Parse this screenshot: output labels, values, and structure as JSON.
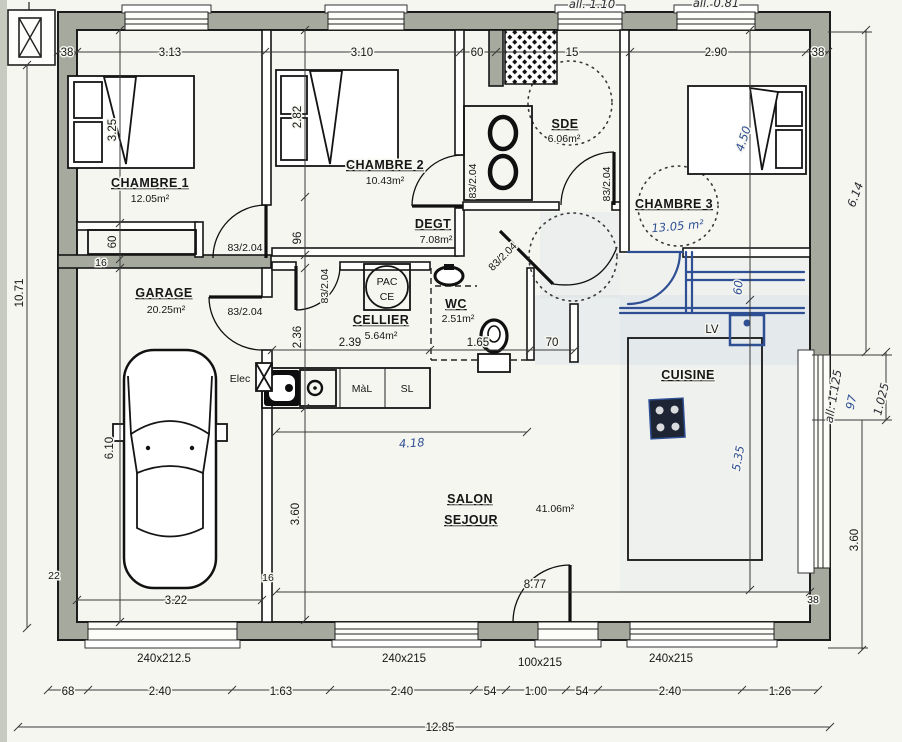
{
  "plan": {
    "rooms": {
      "chambre1": {
        "name": "CHAMBRE 1",
        "area": "12.05m²"
      },
      "chambre2": {
        "name": "CHAMBRE 2",
        "area": "10.43m²"
      },
      "chambre3": {
        "name": "CHAMBRE 3",
        "area": "13.05 m²"
      },
      "sde": {
        "name": "SDE",
        "area": "6.06m²"
      },
      "degt": {
        "name": "DEGT",
        "area": "7.08m²"
      },
      "garage": {
        "name": "GARAGE",
        "area": "20.25m²"
      },
      "cellier": {
        "name": "CELLIER",
        "area": "5.64m²"
      },
      "wc": {
        "name": "WC",
        "area": "2.51m²"
      },
      "cuisine": {
        "name": "CUISINE"
      },
      "salon": {
        "line1": "SALON",
        "line2": "SEJOUR",
        "area": "41.06m²"
      }
    },
    "equipment": {
      "pac_line1": "PAC",
      "pac_line2": "CE",
      "washer": "MàL",
      "dryer": "SL",
      "dishwasher": "LV",
      "elec": "Elec"
    },
    "door_label": "83/2.04",
    "dims": {
      "top": {
        "t38l": "38",
        "t313": "3.13",
        "t310": "3.10",
        "t60": "60",
        "t15": "15",
        "t290": "2.90",
        "t38r": "38"
      },
      "top_hand": {
        "a110": "all. 1.10",
        "a081": "all. 0.81"
      },
      "left": {
        "total": "10.71",
        "v325": "3.25",
        "v60": "60",
        "v610": "6.10",
        "w16": "16",
        "w22": "22"
      },
      "right": {
        "hand614": "6.14",
        "all1125": "all: 1.125",
        "h97": "97",
        "h1025": "1.025",
        "v360": "3.60",
        "w38": "38"
      },
      "inner": {
        "v282": "2.82",
        "v96": "96",
        "v236": "2.36",
        "v360": "3.60",
        "h239": "2.39",
        "h165": "1.65",
        "h70": "70",
        "h877": "8.77",
        "h322": "3.22",
        "w16": "16",
        "h418": "4.18",
        "v450": "4.50",
        "v535": "5.35",
        "v60b": "60"
      },
      "bottom": {
        "openings": {
          "o1": "240x212.5",
          "o2": "240x215",
          "o3": "100x215",
          "o4": "240x215"
        },
        "row": {
          "r68": "68",
          "r240a": "2.40",
          "r163": "1.63",
          "r240b": "2.40",
          "r54a": "54",
          "r100": "1.00",
          "r54b": "54",
          "r240c": "2.40",
          "r126": "1.26"
        },
        "total": "12.85"
      }
    }
  }
}
